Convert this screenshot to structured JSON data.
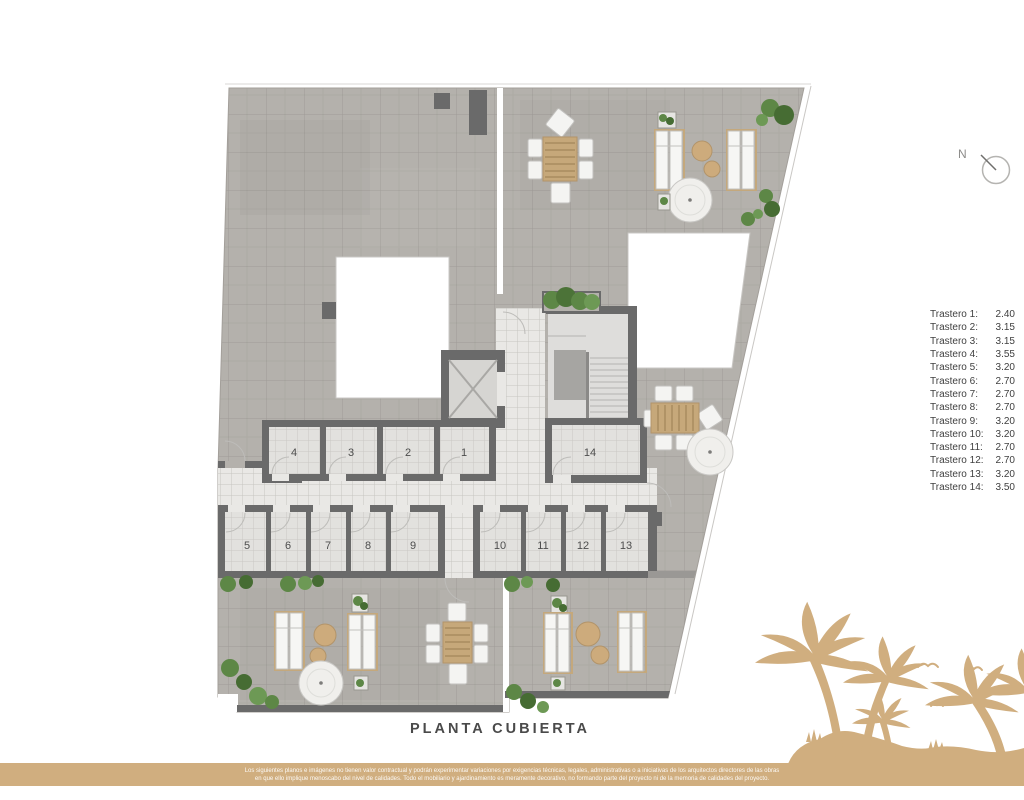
{
  "title": "PLANTA CUBIERTA",
  "north": {
    "label": "N"
  },
  "legend": {
    "items": [
      {
        "label": "Trastero 1:",
        "value": "2.40"
      },
      {
        "label": "Trastero 2:",
        "value": "3.15"
      },
      {
        "label": "Trastero 3:",
        "value": "3.15"
      },
      {
        "label": "Trastero 4:",
        "value": "3.55"
      },
      {
        "label": "Trastero 5:",
        "value": "3.20"
      },
      {
        "label": "Trastero 6:",
        "value": "2.70"
      },
      {
        "label": "Trastero 7:",
        "value": "2.70"
      },
      {
        "label": "Trastero 8:",
        "value": "2.70"
      },
      {
        "label": "Trastero 9:",
        "value": "3.20"
      },
      {
        "label": "Trastero 10:",
        "value": "3.20"
      },
      {
        "label": "Trastero 11:",
        "value": "2.70"
      },
      {
        "label": "Trastero 12:",
        "value": "2.70"
      },
      {
        "label": "Trastero 13:",
        "value": "3.20"
      },
      {
        "label": "Trastero 14:",
        "value": "3.50"
      }
    ]
  },
  "plan": {
    "storage_numbers": [
      "4",
      "3",
      "2",
      "1",
      "14",
      "5",
      "6",
      "7",
      "8",
      "9",
      "10",
      "11",
      "12",
      "13"
    ],
    "icons": [
      "north-indicator",
      "elevator",
      "staircase",
      "dining-set",
      "sun-lounger",
      "parasol",
      "side-table",
      "planter",
      "bush",
      "door-arc",
      "palm-trees-illustration",
      "seagull"
    ]
  },
  "footer": {
    "line1": "Los siguientes planos e imágenes no tienen valor contractual y podrán experimentar variaciones por exigencias técnicas, legales, administrativas o a iniciativas de los arquitectos directores de las obras",
    "line2": "en que ello implique menoscabo del nivel de calidades. Todo el mobiliario y ajardinamiento es meramente decorativo, no formando parte del proyecto ni de la memoria de calidades del proyecto."
  },
  "colors": {
    "accent_tan": "#d0ae7f",
    "wall_gray": "#6a6a6a",
    "roof_gray": "#b4b1ac",
    "corridor_tile": "#e9e8e5",
    "greenery": "#5d8746",
    "parasol_white": "#f0efec"
  }
}
